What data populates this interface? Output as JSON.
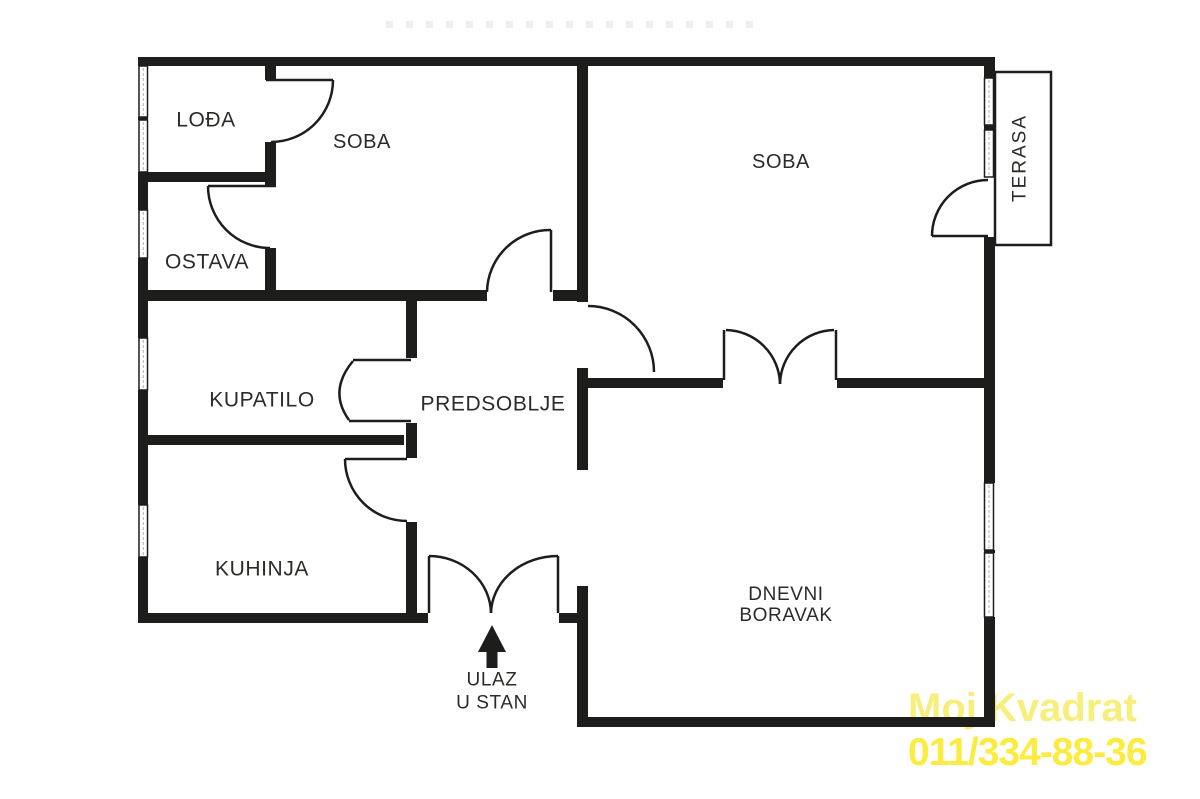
{
  "plan": {
    "rooms": {
      "lodja": {
        "label": "LOĐA"
      },
      "ostava": {
        "label": "OSTAVA"
      },
      "soba_1": {
        "label": "SOBA"
      },
      "soba_2": {
        "label": "SOBA"
      },
      "kupatilo": {
        "label": "KUPATILO"
      },
      "predsoblje": {
        "label": "PREDSOBLJE"
      },
      "kuhinja": {
        "label": "KUHINJA"
      },
      "dnevni_boravak": {
        "line1": "DNEVNI",
        "line2": "BORAVAK"
      },
      "terasa": {
        "label": "TERASA"
      }
    },
    "entrance": {
      "line1": "ULAZ",
      "line2": "U STAN"
    }
  },
  "watermark": {
    "line1": "Moj Kvadrat",
    "line2": "011/334-88-36",
    "color_line1": "#f7ef7c",
    "color_line2": "#fbec3f"
  },
  "colors": {
    "wall": "#1d1d1b",
    "label": "#2b2b28",
    "background": "#ffffff"
  }
}
